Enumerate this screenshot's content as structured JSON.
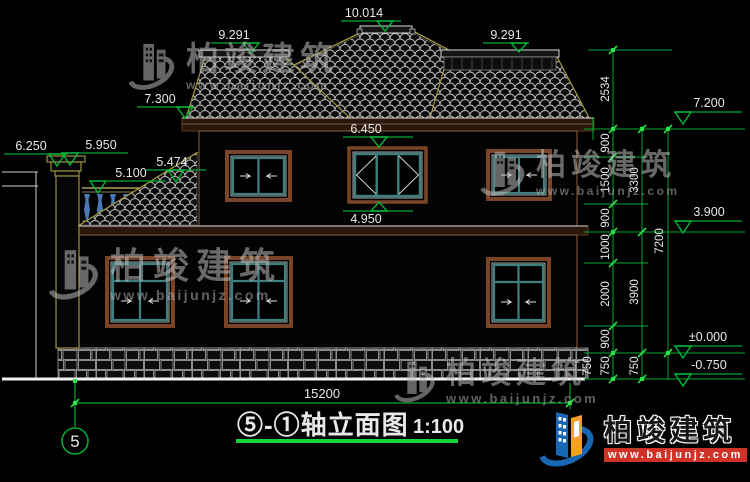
{
  "drawing": {
    "title": "⑤-①轴立面图",
    "title_scale": "1:100",
    "axis_bubble": "5",
    "elevations": {
      "ridge": "10.014",
      "sub_ridge_left": "9.291",
      "sub_ridge_right": "9.291",
      "eave_left": "7.300",
      "chimney_top": "6.250",
      "parapet": "5.950",
      "railing": "5.100",
      "shed_roof": "5.474",
      "window_head": "6.450",
      "window_sill": "4.950",
      "eave_right": "7.200",
      "second_floor": "3.900",
      "ground_floor": "±0.000",
      "site_ground": "-0.750"
    },
    "dimensions": {
      "total_width": "15200",
      "right_chain_a": [
        "2534",
        "900",
        "1500",
        "900",
        "1000",
        "2000",
        "900",
        "750"
      ],
      "right_chain_b": [
        "3300",
        "3900",
        "750"
      ],
      "right_chain_c": [
        "7200"
      ],
      "extra_750": "750"
    }
  },
  "watermark": {
    "name": "柏竣建筑",
    "url": "www.baijunjz.com"
  },
  "logo": {
    "name": "柏竣建筑",
    "url": "www.baijunjz.com"
  },
  "colors": {
    "dim_green": "#00a832",
    "grip_green": "#2ce04a",
    "cad_white": "#e8e8e8",
    "roof_edge_yellow": "#a3983f",
    "frame_brown": "#7a4526",
    "mullion_teal": "#3e8080",
    "baluster_blue": "#4a7ab5",
    "logo_blue": "#1867b5",
    "logo_orange": "#f5a21b",
    "url_bar_red": "#d03228"
  }
}
